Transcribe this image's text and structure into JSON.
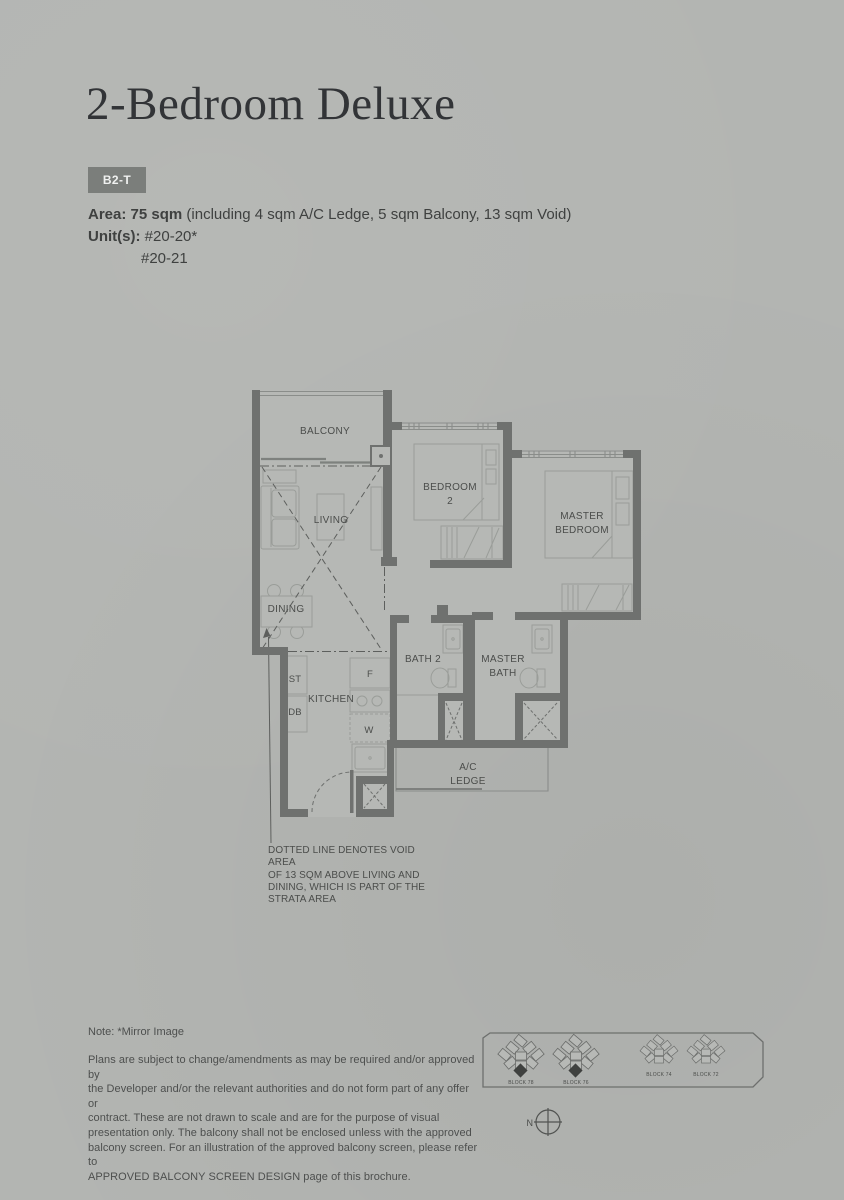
{
  "header": {
    "title": "2-Bedroom Deluxe",
    "type_code": "B2-T",
    "area_label": "Area:",
    "area_value": "75 sqm",
    "area_detail": "(including 4 sqm A/C Ledge, 5 sqm Balcony, 13 sqm Void)",
    "units_label": "Unit(s):",
    "units": [
      "#20-20*",
      "#20-21"
    ]
  },
  "floorplan": {
    "labels": {
      "balcony": "BALCONY",
      "living": "LIVING",
      "dining": "DINING",
      "bedroom2_l1": "BEDROOM",
      "bedroom2_l2": "2",
      "master_l1": "MASTER",
      "master_l2": "BEDROOM",
      "bath2": "BATH 2",
      "master_bath_l1": "MASTER",
      "master_bath_l2": "BATH",
      "kitchen": "KITCHEN",
      "store": "ST",
      "db": "DB",
      "fridge": "F",
      "washer": "W",
      "ac_ledge_l1": "A/C",
      "ac_ledge_l2": "LEDGE"
    },
    "void_note": [
      "DOTTED LINE DENOTES VOID AREA",
      "OF 13 SQM ABOVE LIVING AND",
      "DINING, WHICH IS PART OF THE",
      "STRATA AREA"
    ]
  },
  "siteplan": {
    "blocks": [
      "BLOCK 78",
      "BLOCK 76",
      "BLOCK 74",
      "BLOCK 72"
    ],
    "north_label": "N"
  },
  "footer": {
    "mirror_note": "Note: *Mirror Image",
    "disclaimer": [
      "Plans are subject to change/amendments as may be required and/or approved by",
      "the Developer and/or the relevant authorities and do not form part of any offer or",
      "contract. These are not drawn to scale and are for the purpose of visual",
      "presentation only. The balcony shall not be enclosed unless with the approved",
      "balcony screen. For an illustration of the approved balcony screen, please refer to",
      "APPROVED BALCONY SCREEN DESIGN page of this brochure."
    ]
  },
  "colors": {
    "background": "#b3b5b2",
    "badge": "#7b7e7b",
    "wall": "#6f716f",
    "thin_line": "#8a8d8a",
    "label_text": "#4b4d4b",
    "title_text": "#323437",
    "highlight_unit": "#3f413f"
  }
}
